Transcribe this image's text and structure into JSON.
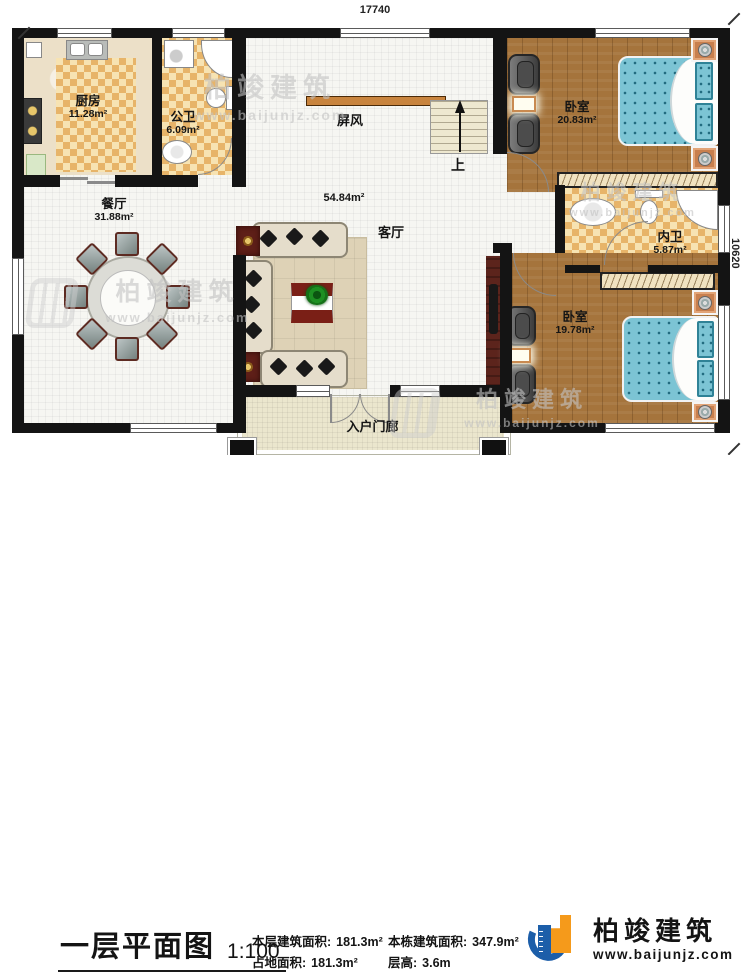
{
  "dimensions": {
    "top": "17740",
    "right": "10620"
  },
  "rooms": {
    "kitchen": {
      "name": "厨房",
      "area": "11.28m²"
    },
    "public_bath": {
      "name": "公卫",
      "area": "6.09m²"
    },
    "screen": {
      "name": "屏风"
    },
    "living": {
      "name": "客厅",
      "area": "54.84m²"
    },
    "dining": {
      "name": "餐厅",
      "area": "31.88m²"
    },
    "bedroom_top": {
      "name": "卧室",
      "area": "20.83m²"
    },
    "inner_bath": {
      "name": "内卫",
      "area": "5.87m²"
    },
    "bedroom_bottom": {
      "name": "卧室",
      "area": "19.78m²"
    },
    "porch": {
      "name": "入户门廊"
    },
    "stairs": {
      "up": "上"
    }
  },
  "watermark": {
    "brand": "柏竣建筑",
    "site": "www.baijunjz.com"
  },
  "footer": {
    "title": "一层平面图",
    "scale": "1:100",
    "stats": [
      {
        "label": "本层建筑面积:",
        "value": "181.3m²"
      },
      {
        "label": "占地面积:",
        "value": "181.3m²"
      },
      {
        "label": "本栋建筑面积:",
        "value": "347.9m²"
      },
      {
        "label": "层高:",
        "value": "3.6m"
      }
    ],
    "logo": {
      "name": "柏竣建筑",
      "url": "www.baijunjz.com"
    }
  },
  "colors": {
    "wall": "#141414",
    "tile_dark": "#e7b469",
    "tile_light": "#f7e3b2",
    "wood": "#a5743c",
    "bed": "#7cc4d4",
    "logo_blue": "#1c5ea9",
    "logo_orange": "#f59a1b"
  }
}
